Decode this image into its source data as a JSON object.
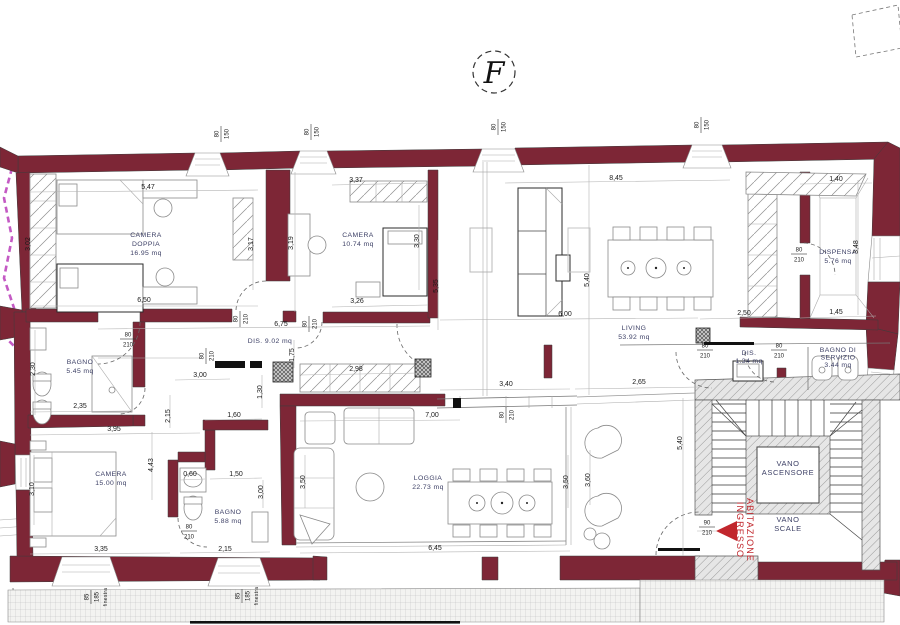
{
  "meta": {
    "section_mark": "F"
  },
  "style": {
    "wall_color": "#7d2636",
    "accent_red": "#c1272d",
    "boundary_magenta": "#c45ac4",
    "room_label_color": "#3d4066"
  },
  "rooms": [
    {
      "id": "camera-doppia",
      "lines": [
        "CAMERA",
        "DOPPIA",
        "16.95 mq"
      ],
      "x": 146,
      "y": 237,
      "lh": 9
    },
    {
      "id": "camera",
      "lines": [
        "CAMERA",
        "10.74 mq"
      ],
      "x": 358,
      "y": 237,
      "lh": 9
    },
    {
      "id": "living",
      "lines": [
        "LIVING",
        "53.92 mq"
      ],
      "x": 634,
      "y": 330,
      "lh": 9
    },
    {
      "id": "dispensa",
      "lines": [
        "DISPENSA",
        "5.76 mq"
      ],
      "x": 838,
      "y": 254,
      "lh": 9
    },
    {
      "id": "disimpegno-giorno",
      "lines": [
        "DIS. 9.02 mq"
      ],
      "x": 270,
      "y": 343,
      "lh": 9
    },
    {
      "id": "bagno-1",
      "lines": [
        "BAGNO",
        "5.45 mq"
      ],
      "x": 80,
      "y": 364,
      "lh": 9
    },
    {
      "id": "camera-matrimoniale",
      "lines": [
        "CAMERA",
        "15.00 mq"
      ],
      "x": 111,
      "y": 476,
      "lh": 9
    },
    {
      "id": "bagno-2",
      "lines": [
        "BAGNO",
        "5.88 mq"
      ],
      "x": 228,
      "y": 514,
      "lh": 9
    },
    {
      "id": "loggia",
      "lines": [
        "LOGGIA",
        "22.73 mq"
      ],
      "x": 428,
      "y": 480,
      "lh": 9
    },
    {
      "id": "dis-servizio",
      "lines": [
        "DIS.",
        "1.34 mq"
      ],
      "x": 749,
      "y": 355,
      "lh": 8
    },
    {
      "id": "bagno-servizio",
      "lines": [
        "BAGNO DI",
        "SERVIZIO",
        "3.44 mq"
      ],
      "x": 838,
      "y": 352,
      "lh": 7.5
    },
    {
      "id": "vano-ascensore",
      "lines": [
        "VANO",
        "ASCENSORE"
      ],
      "x": 788,
      "y": 466,
      "lh": 9,
      "cls": "vano-label"
    },
    {
      "id": "vano-scale",
      "lines": [
        "VANO",
        "SCALE"
      ],
      "x": 788,
      "y": 522,
      "lh": 9,
      "cls": "vano-label"
    }
  ],
  "entrance": {
    "lines": [
      "INGRESSO",
      "ABITAZIONE"
    ],
    "x": 742,
    "y": 530
  },
  "dimensions": [
    {
      "t": "5,47",
      "x": 148,
      "y": 189
    },
    {
      "t": "3,02",
      "x": 30,
      "y": 244,
      "r": 1
    },
    {
      "t": "3,17",
      "x": 253,
      "y": 244,
      "r": 1
    },
    {
      "t": "3,19",
      "x": 293,
      "y": 243,
      "r": 1
    },
    {
      "t": "6,50",
      "x": 144,
      "y": 302
    },
    {
      "t": "6,75",
      "x": 281,
      "y": 326
    },
    {
      "t": "1,75",
      "x": 294,
      "y": 355,
      "r": 1
    },
    {
      "t": "3,37",
      "x": 356,
      "y": 182
    },
    {
      "t": "3,30",
      "x": 419,
      "y": 241,
      "r": 1
    },
    {
      "t": "3,26",
      "x": 357,
      "y": 303
    },
    {
      "t": "5,35",
      "x": 438,
      "y": 286,
      "r": 1
    },
    {
      "t": "8,45",
      "x": 616,
      "y": 180
    },
    {
      "t": "1,40",
      "x": 836,
      "y": 181
    },
    {
      "t": "5,40",
      "x": 589,
      "y": 280,
      "r": 1
    },
    {
      "t": "3,48",
      "x": 858,
      "y": 247,
      "r": 1
    },
    {
      "t": "6,00",
      "x": 565,
      "y": 316
    },
    {
      "t": "2,50",
      "x": 744,
      "y": 315
    },
    {
      "t": "1,45",
      "x": 836,
      "y": 314
    },
    {
      "t": "2,98",
      "x": 356,
      "y": 371
    },
    {
      "t": "3,00",
      "x": 200,
      "y": 377
    },
    {
      "t": "3,40",
      "x": 506,
      "y": 386
    },
    {
      "t": "2,65",
      "x": 639,
      "y": 384
    },
    {
      "t": "7,00",
      "x": 432,
      "y": 417
    },
    {
      "t": "5,40",
      "x": 682,
      "y": 443,
      "r": 1
    },
    {
      "t": "2,30",
      "x": 35,
      "y": 369,
      "r": 1
    },
    {
      "t": "2,35",
      "x": 80,
      "y": 408
    },
    {
      "t": "3,95",
      "x": 114,
      "y": 431
    },
    {
      "t": "2,15",
      "x": 170,
      "y": 416,
      "r": 1
    },
    {
      "t": "1,60",
      "x": 234,
      "y": 417
    },
    {
      "t": "1,30",
      "x": 262,
      "y": 392,
      "r": 1
    },
    {
      "t": "4,43",
      "x": 153,
      "y": 465,
      "r": 1
    },
    {
      "t": "0,60",
      "x": 190,
      "y": 476
    },
    {
      "t": "1,50",
      "x": 236,
      "y": 476
    },
    {
      "t": "3,00",
      "x": 263,
      "y": 492,
      "r": 1
    },
    {
      "t": "3,10",
      "x": 34,
      "y": 489,
      "r": 1
    },
    {
      "t": "3,35",
      "x": 101,
      "y": 551
    },
    {
      "t": "2,15",
      "x": 225,
      "y": 551
    },
    {
      "t": "6,45",
      "x": 435,
      "y": 550
    },
    {
      "t": "3,50",
      "x": 305,
      "y": 482,
      "r": 1
    },
    {
      "t": "3,50",
      "x": 568,
      "y": 482,
      "r": 1
    },
    {
      "t": "3,60",
      "x": 590,
      "y": 480,
      "r": 1
    }
  ],
  "opening_markers": [
    {
      "a": "80",
      "b": "150",
      "x": 220,
      "y": 134,
      "r": 1
    },
    {
      "a": "80",
      "b": "150",
      "x": 310,
      "y": 132,
      "r": 1
    },
    {
      "a": "80",
      "b": "150",
      "x": 497,
      "y": 127,
      "r": 1
    },
    {
      "a": "80",
      "b": "150",
      "x": 700,
      "y": 125,
      "r": 1
    },
    {
      "a": "80",
      "b": "210",
      "x": 128,
      "y": 338
    },
    {
      "a": "80",
      "b": "210",
      "x": 239,
      "y": 319,
      "r": 1
    },
    {
      "a": "80",
      "b": "210",
      "x": 308,
      "y": 324,
      "r": 1
    },
    {
      "a": "80",
      "b": "210",
      "x": 205,
      "y": 356,
      "r": 1
    },
    {
      "a": "80",
      "b": "210",
      "x": 799,
      "y": 253
    },
    {
      "a": "80",
      "b": "210",
      "x": 705,
      "y": 349
    },
    {
      "a": "80",
      "b": "210",
      "x": 779,
      "y": 349
    },
    {
      "a": "80",
      "b": "210",
      "x": 189,
      "y": 530
    },
    {
      "a": "80",
      "b": "210",
      "x": 505,
      "y": 415,
      "r": 1
    },
    {
      "a": "90",
      "b": "210",
      "x": 707,
      "y": 526
    }
  ],
  "window_tags": [
    {
      "a": "85",
      "b": "185",
      "word": "finestra",
      "x": 90,
      "y": 597
    },
    {
      "a": "85",
      "b": "185",
      "word": "finestra",
      "x": 241,
      "y": 596
    }
  ]
}
